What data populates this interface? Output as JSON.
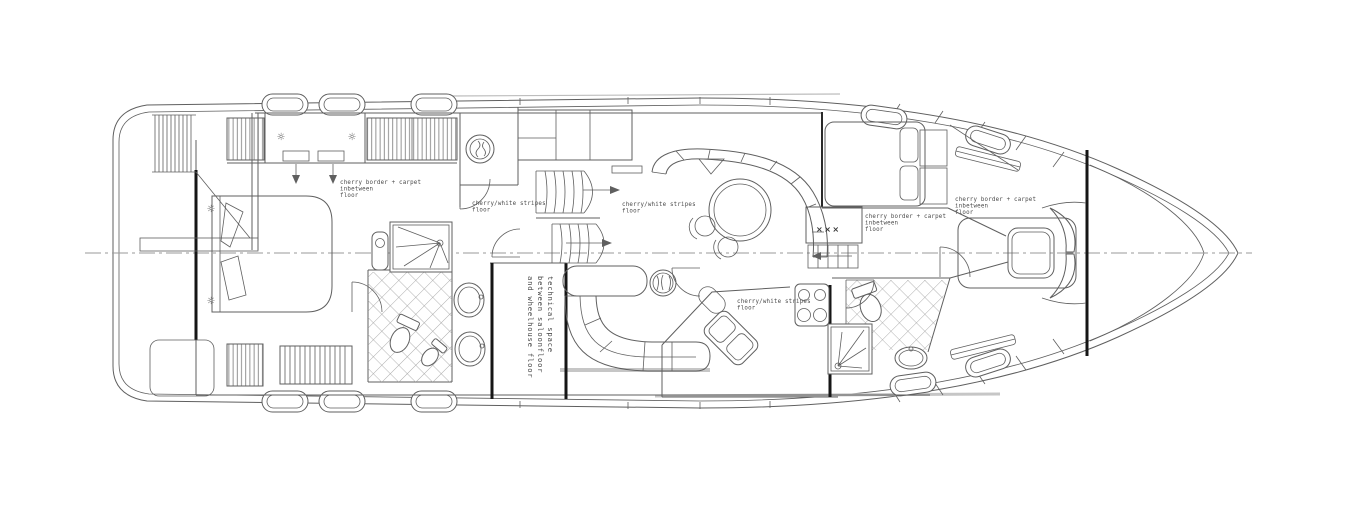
{
  "page": {
    "background": "#ffffff"
  },
  "drawing": {
    "type": "yacht interior deck floor plan, CAD line drawing, bow pointing right",
    "colors": {
      "line": "#5f5f5f",
      "bulkhead": "#161616",
      "centerline": "#9a9a9a",
      "deck_gray": "#bdbdbd",
      "background": "#ffffff"
    },
    "labels": {
      "cherry_border_carpet": {
        "line1": "cherry border + carpet",
        "line2": "inbetween",
        "line3": "floor"
      },
      "cherry_white_stripes": {
        "line1": "cherry/white stripes",
        "line2": "floor"
      },
      "technical_space": {
        "line1": "technical space",
        "line2": "between saloonfloor",
        "line3": "and wheelhouse floor"
      },
      "vent_marks": "×××"
    },
    "icons": {
      "ceiling_light": "☼"
    }
  }
}
